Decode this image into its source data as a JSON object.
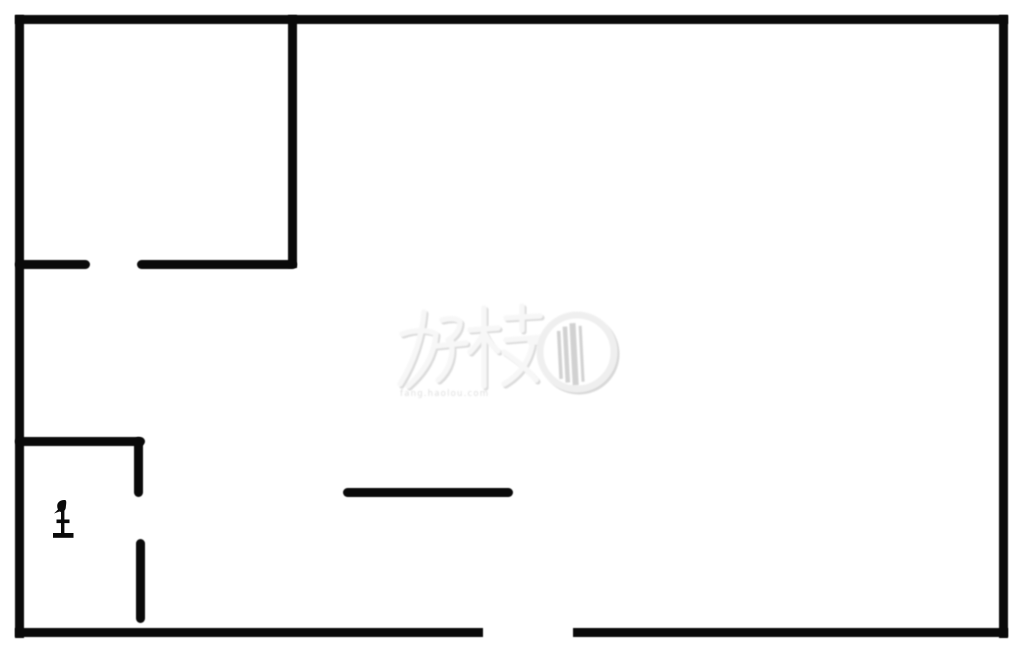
{
  "page": {
    "background_color": "#ffffff",
    "wall_color": "#0a0a0a"
  },
  "diagram": {
    "type": "floorplan",
    "canvas": {
      "width": 1020,
      "height": 652
    },
    "walls": [
      {
        "id": "outer-top",
        "x": 15,
        "y": 15,
        "w": 993,
        "h": 9,
        "cap": "square"
      },
      {
        "id": "outer-left",
        "x": 15,
        "y": 15,
        "w": 9,
        "h": 623,
        "cap": "square"
      },
      {
        "id": "outer-right",
        "x": 999,
        "y": 15,
        "w": 9,
        "h": 623,
        "cap": "square"
      },
      {
        "id": "outer-bottom-left",
        "x": 15,
        "y": 628,
        "w": 468,
        "h": 9,
        "cap": "square"
      },
      {
        "id": "outer-bottom-right",
        "x": 573,
        "y": 628,
        "w": 435,
        "h": 9,
        "cap": "square"
      },
      {
        "id": "room-topleft-right-wall",
        "x": 288,
        "y": 15,
        "w": 9,
        "h": 253,
        "cap": "square"
      },
      {
        "id": "room-topleft-bottom-wall-left",
        "x": 15,
        "y": 260,
        "w": 75,
        "h": 9,
        "cap": "round"
      },
      {
        "id": "room-topleft-bottom-wall-right",
        "x": 137,
        "y": 260,
        "w": 160,
        "h": 9,
        "cap": "round"
      },
      {
        "id": "room-bottomleft-top-wall",
        "x": 15,
        "y": 437,
        "w": 130,
        "h": 9,
        "cap": "round"
      },
      {
        "id": "room-bottomleft-right-wall-upper",
        "x": 134,
        "y": 437,
        "w": 9,
        "h": 60,
        "cap": "round"
      },
      {
        "id": "room-bottomleft-right-wall-lower",
        "x": 136,
        "y": 539,
        "w": 9,
        "h": 84,
        "cap": "round"
      },
      {
        "id": "partition-middle",
        "x": 343,
        "y": 488,
        "w": 170,
        "h": 9,
        "cap": "round"
      }
    ],
    "openings": [
      {
        "id": "door-room-topleft",
        "x": 90,
        "y": 260,
        "w": 47,
        "h": 9
      },
      {
        "id": "door-room-bottomleft",
        "x": 134,
        "y": 497,
        "w": 9,
        "h": 42
      },
      {
        "id": "entrance-bottom",
        "x": 483,
        "y": 628,
        "w": 90,
        "h": 9
      }
    ],
    "fixture": {
      "icon": "toilet-icon",
      "x": 50,
      "y": 499,
      "color": "#0a0a0a"
    }
  },
  "watermark": {
    "logo_text": "好楼",
    "subtext": "fang.haolou.com",
    "logo_color": "#e9e9e9",
    "shadow_color": "#d9d9d9",
    "circle_bars_color": "#cfcfcf"
  }
}
